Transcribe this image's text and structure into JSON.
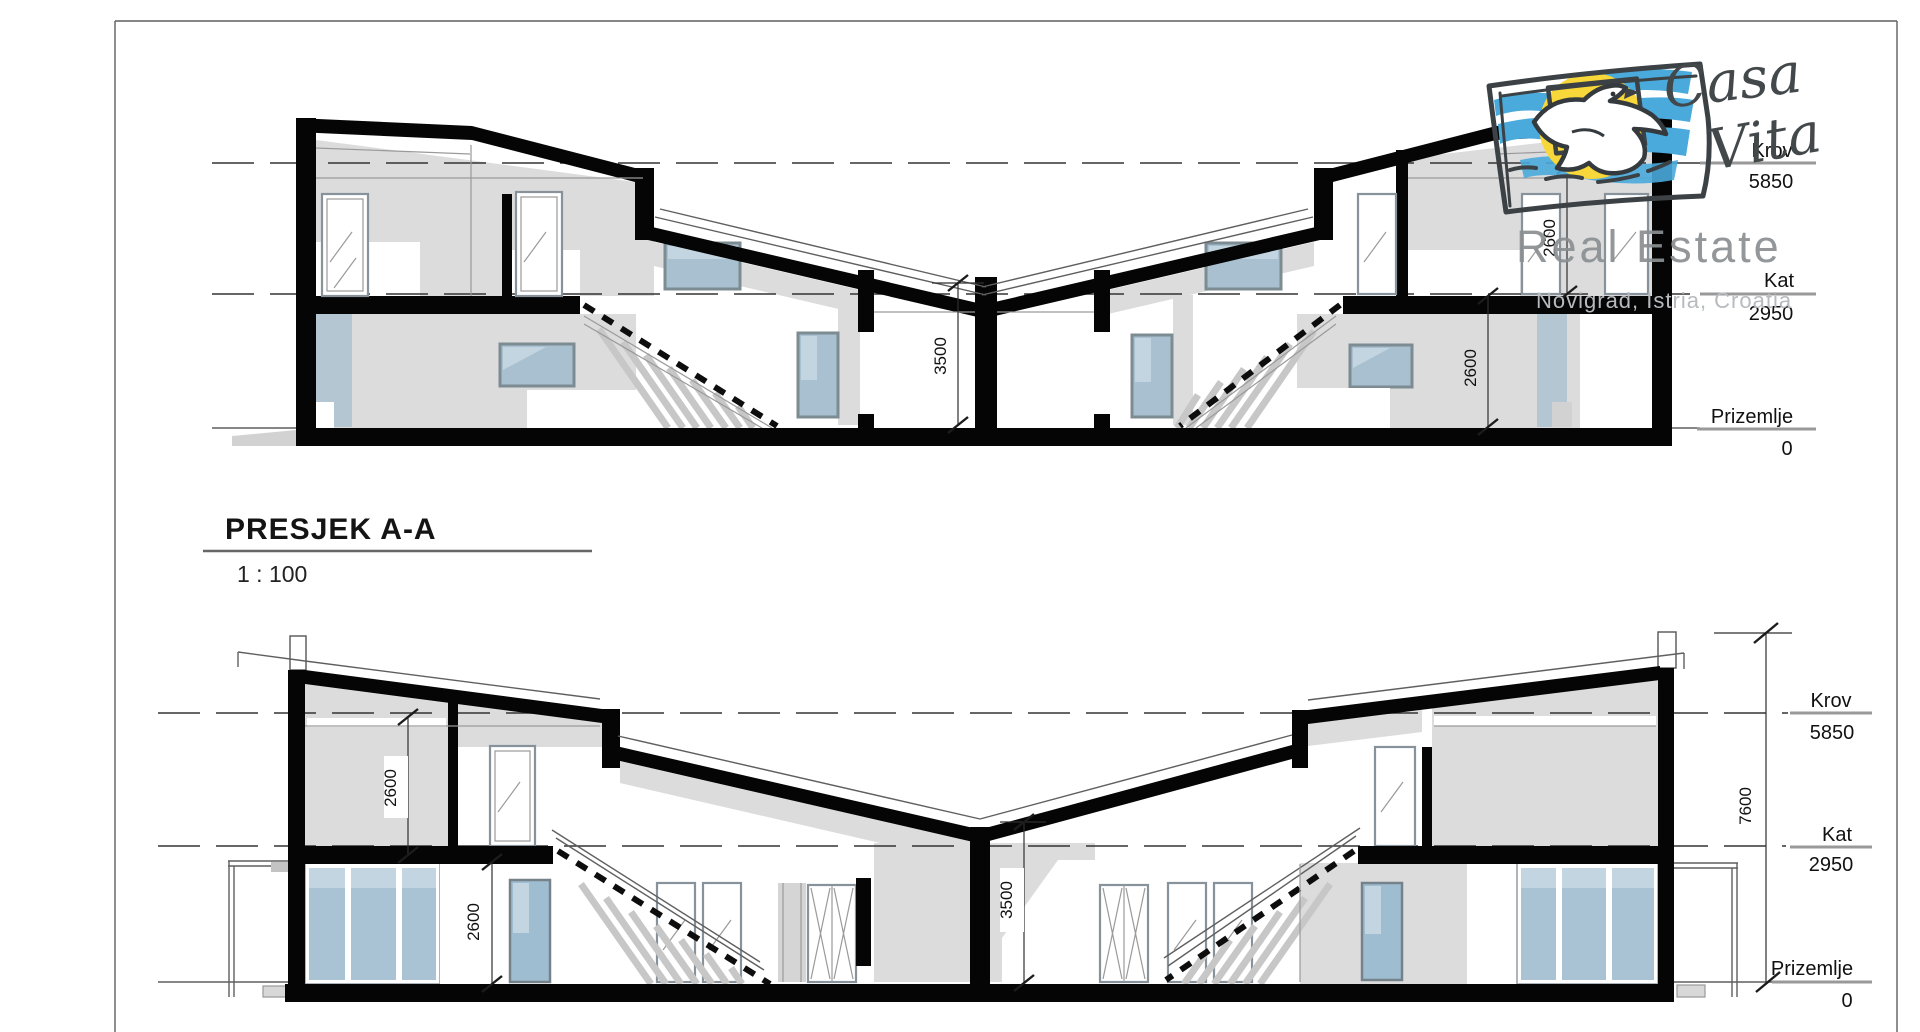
{
  "title_block": {
    "title": "PRESJEK A-A",
    "scale": "1 : 100"
  },
  "logo": {
    "brand_line1": "Casa",
    "brand_line2": "Vita",
    "subtitle": "Real Estate",
    "location": "Novigrad, Istria, Croatia",
    "icon": "dove-sun-sketch-icon"
  },
  "levels": {
    "krov": {
      "label": "Krov",
      "value": "5850"
    },
    "kat": {
      "label": "Kat",
      "value": "2950"
    },
    "prizemlje": {
      "label": "Prizemlje",
      "value": "0"
    }
  },
  "dimensions": {
    "top_section": {
      "hall_height": "3500",
      "room_height": "2600",
      "upper_room_height": "2600"
    },
    "bottom_section": {
      "upper_room_height": "2600",
      "ground_room_height": "2600",
      "hall_height": "3500",
      "total_height": "7600"
    }
  },
  "colors": {
    "wall_black": "#050505",
    "interior_gray": "#dcdcdc",
    "glass_blue": "#a9c3d4",
    "logo_blue": "#49aadb",
    "logo_yellow": "#f8d73a",
    "logo_ink": "#3b4145",
    "watermark_gray": "#8a8f92"
  }
}
